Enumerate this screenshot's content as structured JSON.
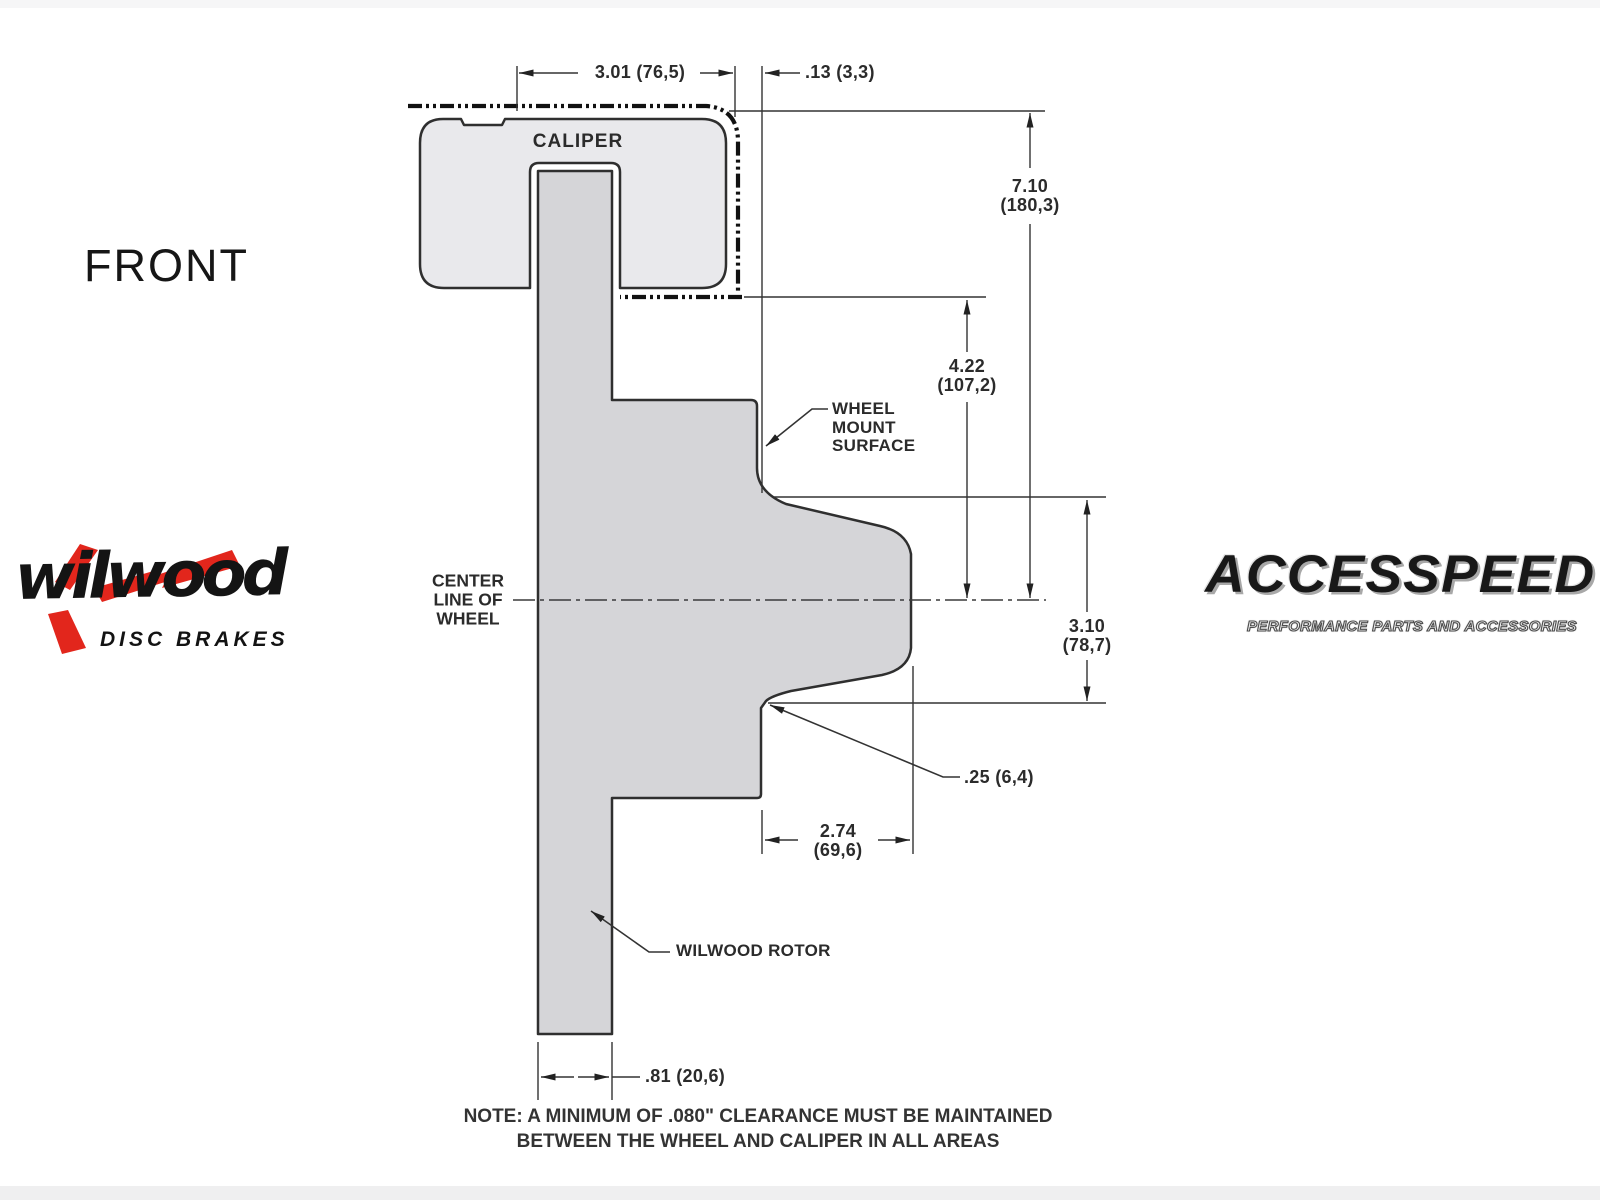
{
  "front_view_label": "FRONT",
  "drawing": {
    "caliper_label": "CALIPER",
    "wheel_mount_surface_label": "WHEEL\nMOUNT\nSURFACE",
    "center_line_label": "CENTER\nLINE OF\nWHEEL",
    "rotor_label": "WILWOOD ROTOR",
    "dimensions": {
      "caliper_width": "3.01 (76,5)",
      "caliper_wheel_clearance": ".13 (3,3)",
      "caliper_top_to_centerline": "7.10\n(180,3)",
      "caliper_bottom_to_centerline": "4.22\n(107,2)",
      "mount_face_to_step": "3.10\n(78,7)",
      "step_depth": ".25 (6,4)",
      "hub_depth": "2.74\n(69,6)",
      "rotor_thickness": ".81 (20,6)"
    },
    "note": "NOTE: A MINIMUM OF .080\" CLEARANCE MUST BE MAINTAINED\nBETWEEN THE WHEEL AND CALIPER IN ALL AREAS"
  },
  "logos": {
    "wilwood": {
      "wordmark": "wilwood",
      "tagline": "DISC BRAKES"
    },
    "accesspeed": {
      "wordmark": "ACCESSPEED",
      "tagline": "PERFORMANCE PARTS AND ACCESSORIES"
    }
  },
  "colors": {
    "caliper_fill": "#e9e9ec",
    "rotor_fill": "#d5d5d8",
    "outline": "#2f2f2f",
    "dimension_line": "#333333",
    "phantom_line": "#111111",
    "wilwood_red": "#e2261c",
    "text": "#2b2b2b"
  }
}
